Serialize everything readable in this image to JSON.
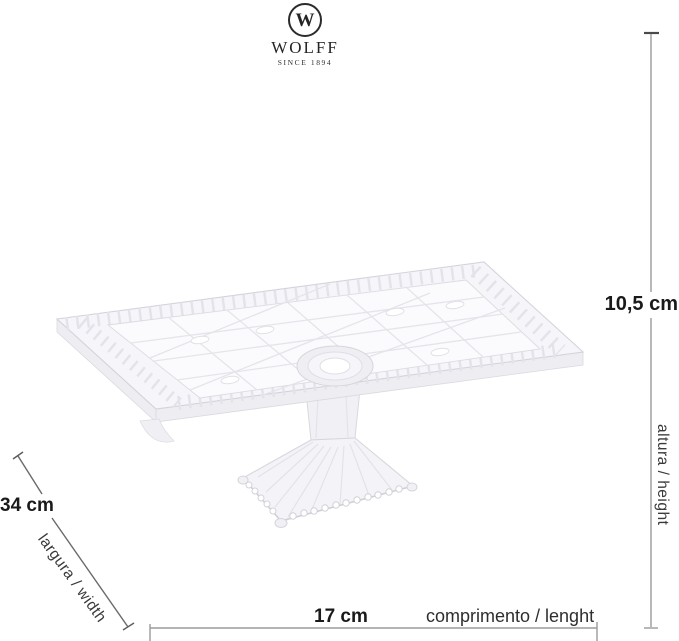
{
  "brand": {
    "initial": "W",
    "name": "WOLFF",
    "tagline": "SINCE 1894"
  },
  "dimensions": {
    "height": {
      "value": "10,5 cm",
      "label": "altura / height"
    },
    "width": {
      "value": "34 cm",
      "label": "largura / width"
    },
    "length": {
      "value": "17 cm",
      "label": "comprimento / lenght"
    }
  },
  "illustration": {
    "name": "crystal-rectangular-cake-stand",
    "glass_fill": "#f6f6fa",
    "glass_stroke": "#d5d5dd",
    "dimension_line_color": "#9b9b9b",
    "value_text_color": "#1a1a1a",
    "label_text_color": "#3a3a3a"
  }
}
